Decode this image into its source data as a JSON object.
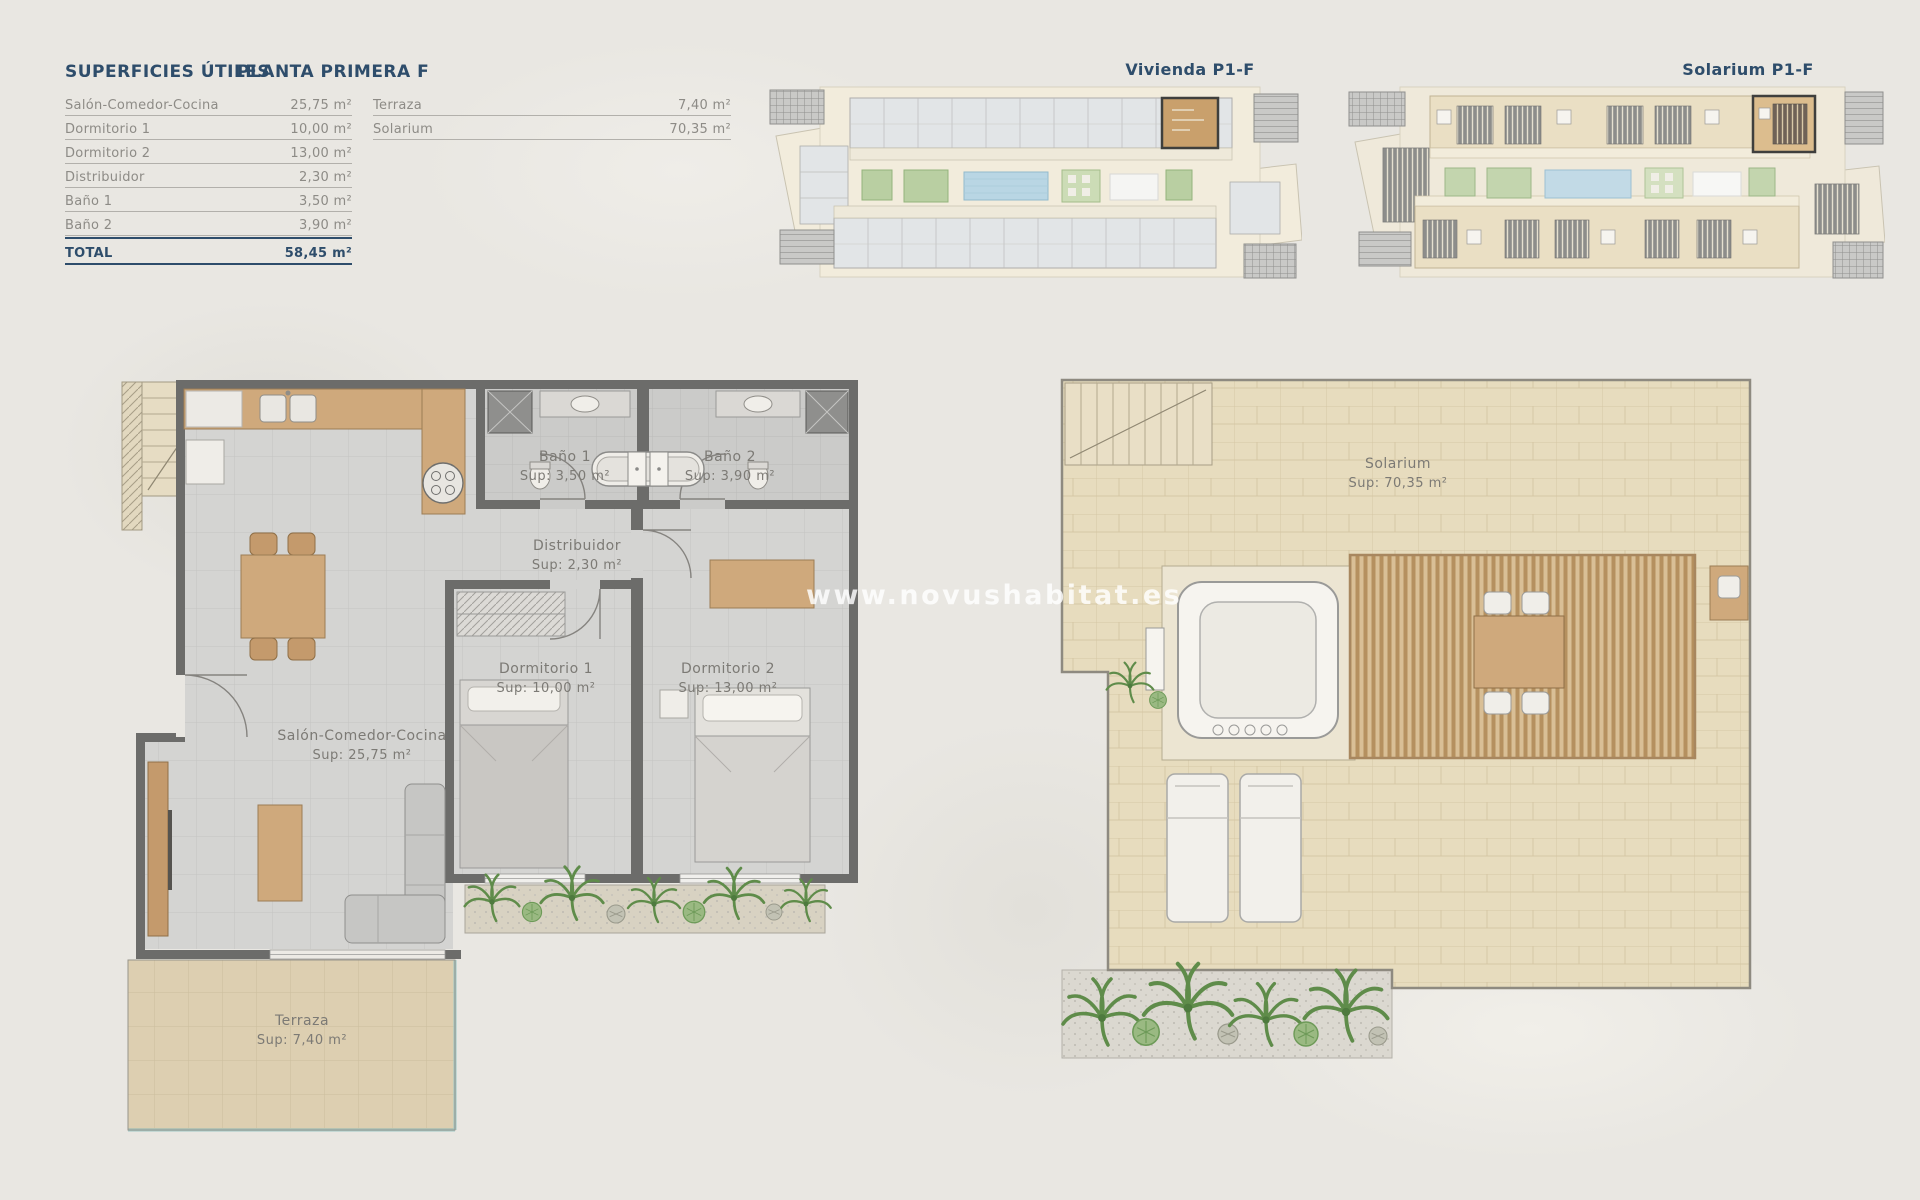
{
  "surfaces_table": {
    "title": "SUPERFICIES ÚTILES",
    "subtitle": "PLANTA PRIMERA F",
    "rows": [
      {
        "label": "Salón-Comedor-Cocina",
        "value": "25,75 m²"
      },
      {
        "label": "Dormitorio 1",
        "value": "10,00 m²"
      },
      {
        "label": "Dormitorio 2",
        "value": "13,00 m²"
      },
      {
        "label": "Distribuidor",
        "value": "2,30 m²"
      },
      {
        "label": "Baño 1",
        "value": "3,50 m²"
      },
      {
        "label": "Baño 2",
        "value": "3,90 m²"
      }
    ],
    "total": {
      "label": "TOTAL",
      "value": "58,45 m²"
    },
    "extra_rows": [
      {
        "label": "Terraza",
        "value": "7,40 m²"
      },
      {
        "label": "Solarium",
        "value": "70,35 m²"
      }
    ]
  },
  "overview_plans": {
    "vivienda": {
      "label": "Vivienda P1-F"
    },
    "solarium": {
      "label": "Solarium P1-F"
    }
  },
  "floor_plan": {
    "rooms": [
      {
        "id": "bano1",
        "name": "Baño 1",
        "sup": "Sup: 3,50 m²"
      },
      {
        "id": "bano2",
        "name": "Baño 2",
        "sup": "Sup: 3,90 m²"
      },
      {
        "id": "distribuidor",
        "name": "Distribuidor",
        "sup": "Sup: 2,30 m²"
      },
      {
        "id": "dormitorio1",
        "name": "Dormitorio 1",
        "sup": "Sup: 10,00 m²"
      },
      {
        "id": "dormitorio2",
        "name": "Dormitorio 2",
        "sup": "Sup: 13,00 m²"
      },
      {
        "id": "salon",
        "name": "Salón-Comedor-Cocina",
        "sup": "Sup: 25,75 m²"
      },
      {
        "id": "terraza",
        "name": "Terraza",
        "sup": "Sup: 7,40 m²"
      }
    ]
  },
  "solarium_plan": {
    "name": "Solarium",
    "sup": "Sup: 70,35 m²"
  },
  "watermark": "www.novushabitat.es",
  "colors": {
    "accent_navy": "#2e4d6b",
    "label_gray": "#8d8b86",
    "wall_gray": "#6c6c6a",
    "floor_tile_gray": "#d4d4d2",
    "bath_tile_gray": "#cbcbc9",
    "terrace_tile_beige": "#ddcfb1",
    "solarium_tile_beige": "#e7dcbe",
    "wood": "#cfa97c",
    "plant_green": "#5f8c4a",
    "pool_blue": "#b9d6e4",
    "background": "#e9e7e2",
    "watermark_white": "#ffffff"
  }
}
